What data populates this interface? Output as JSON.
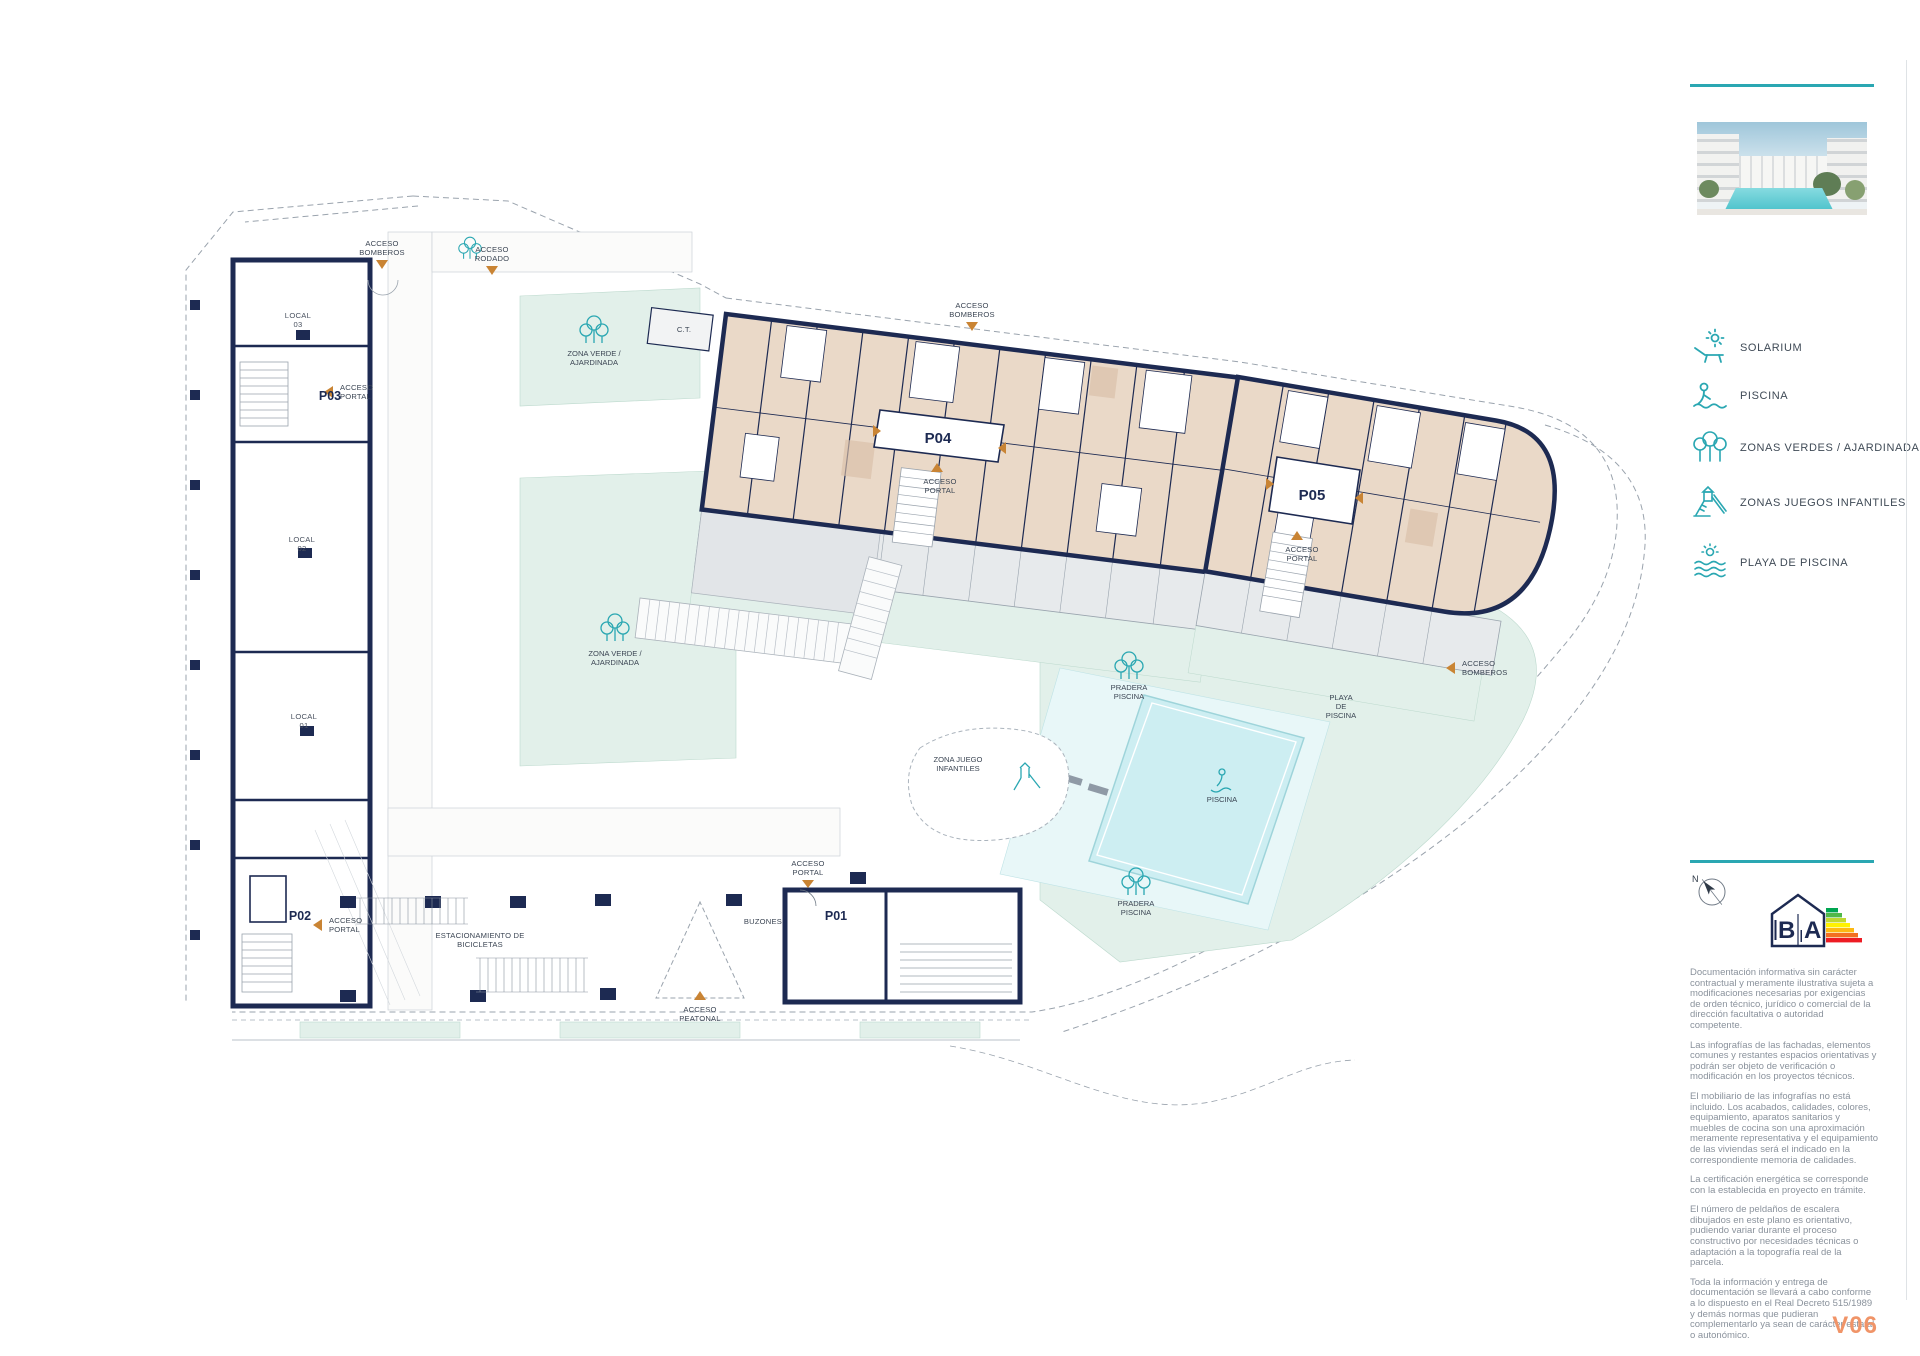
{
  "colors": {
    "teal": "#2aa7b2",
    "navy": "#1d2a52",
    "tan": "#ead9c8",
    "mint": "#e2f0ea",
    "pool": "#cdeef2",
    "terrace_gray": "#e2e5e8",
    "marker_orange": "#c98434",
    "version_orange": "#f09468"
  },
  "panel": {
    "legend": [
      {
        "icon": "solarium-icon",
        "label": "SOLARIUM"
      },
      {
        "icon": "piscina-icon",
        "label": "PISCINA"
      },
      {
        "icon": "zonas-verdes-icon",
        "label": "ZONAS VERDES / AJARDINADAS"
      },
      {
        "icon": "juegos-infantiles-icon",
        "label": "ZONAS JUEGOS INFANTILES"
      },
      {
        "icon": "playa-piscina-icon",
        "label": "PLAYA DE PISCINA"
      }
    ],
    "compass_n": "N",
    "energy": {
      "left_letter": "B",
      "right_letter": "A"
    },
    "disclaimer": [
      "Documentación informativa sin carácter contractual y meramente ilustrativa sujeta a modificaciones necesarias por exigencias de orden técnico, jurídico o comercial de la dirección facultativa o autoridad competente.",
      "Las infografías de las fachadas, elementos comunes y restantes espacios orientativas y podrán ser objeto de verificación o modificación en los proyectos técnicos.",
      "El mobiliario de las infografías no está incluido. Los acabados, calidades, colores, equipamiento, aparatos sanitarios y muebles de cocina son una aproximación meramente representativa y el equipamiento de las viviendas será el indicado en la correspondiente memoria de calidades.",
      "La certificación energética se corresponde con la establecida en proyecto en trámite.",
      "El número de peldaños de escalera dibujados en este plano es orientativo, pudiendo variar durante el proceso constructivo por necesidades técnicas o adaptación a la topografía real de la parcela.",
      "Toda la información y entrega de documentación se llevará a cabo conforme a lo dispuesto en el Real Decreto 515/1989 y demás normas que pudieran complementarlo ya sean de carácter estatal o autonómico."
    ],
    "version": "V06"
  },
  "plan": {
    "portals": {
      "p01": "P01",
      "p02": "P02",
      "p03": "P03",
      "p04": "P04",
      "p05": "P05"
    },
    "locals": {
      "label": "LOCAL",
      "n01": "01",
      "n02": "02",
      "n03": "03"
    },
    "words": {
      "acceso": "ACCESO",
      "bomberos": "BOMBEROS",
      "rodado": "RODADO",
      "portal": "PORTAL",
      "peatonal": "PEATONAL",
      "zona_verde": "ZONA VERDE /",
      "ajardinada": "AJARDINADA",
      "zona_juego": "ZONA JUEGO",
      "infantiles": "INFANTILES",
      "pradera": "PRADERA",
      "piscina": "PISCINA",
      "playa": "PLAYA",
      "de": "DE",
      "ct": "C.T.",
      "buzones": "BUZONES",
      "estacionamiento": "ESTACIONAMIENTO DE",
      "bicicletas": "BICICLETAS"
    }
  }
}
